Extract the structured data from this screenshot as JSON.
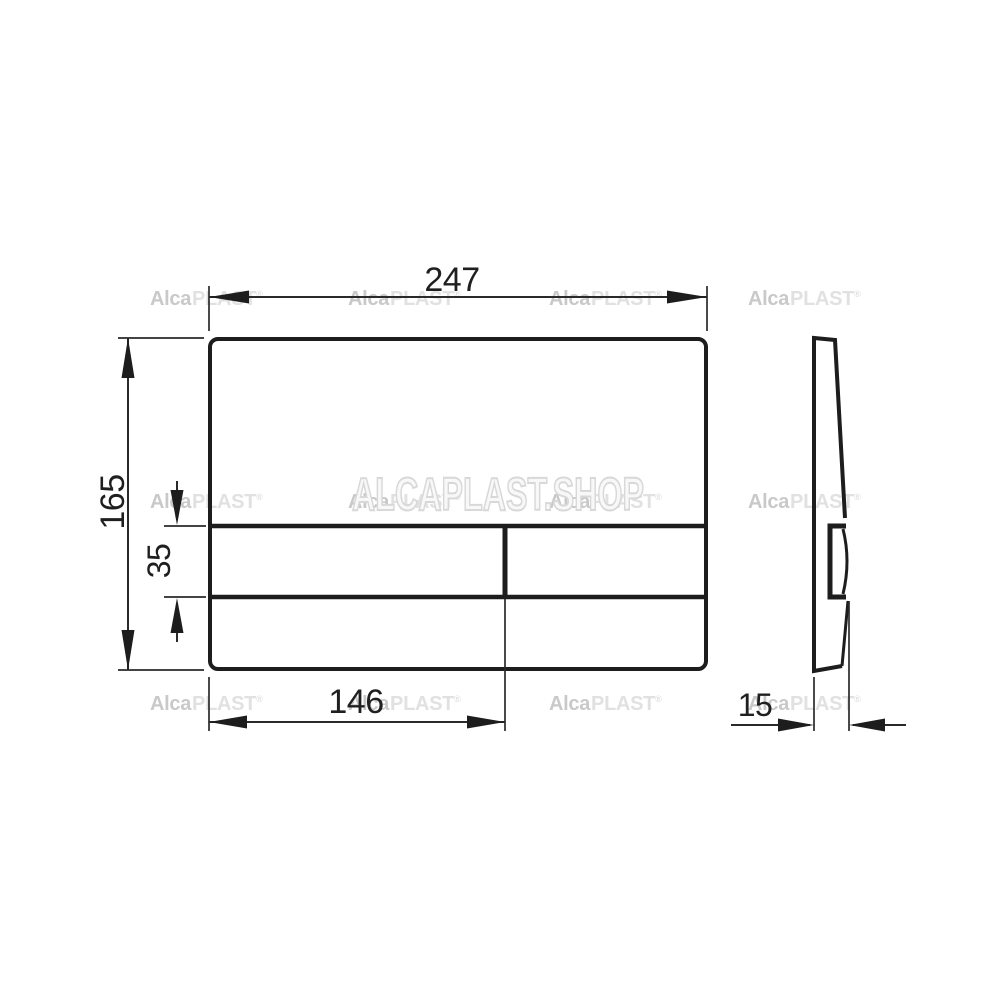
{
  "drawing": {
    "dimensions": {
      "plate_width": "247",
      "plate_height": "165",
      "button_height": "35",
      "button_width": "146",
      "plate_depth": "15"
    },
    "watermark": {
      "brand_alca": "Alca",
      "brand_plast": "PLAST",
      "reg_mark": "®",
      "big_text": "ALCAPLAST.SHOP"
    },
    "colors": {
      "line": "#1d1d1d",
      "dimension_text": "#1f1f1f",
      "watermark_small_dark": "#c9c9c9",
      "watermark_small_light": "#e1e1e1",
      "watermark_big_outline": "#d8d8d8",
      "background": "#ffffff"
    }
  }
}
